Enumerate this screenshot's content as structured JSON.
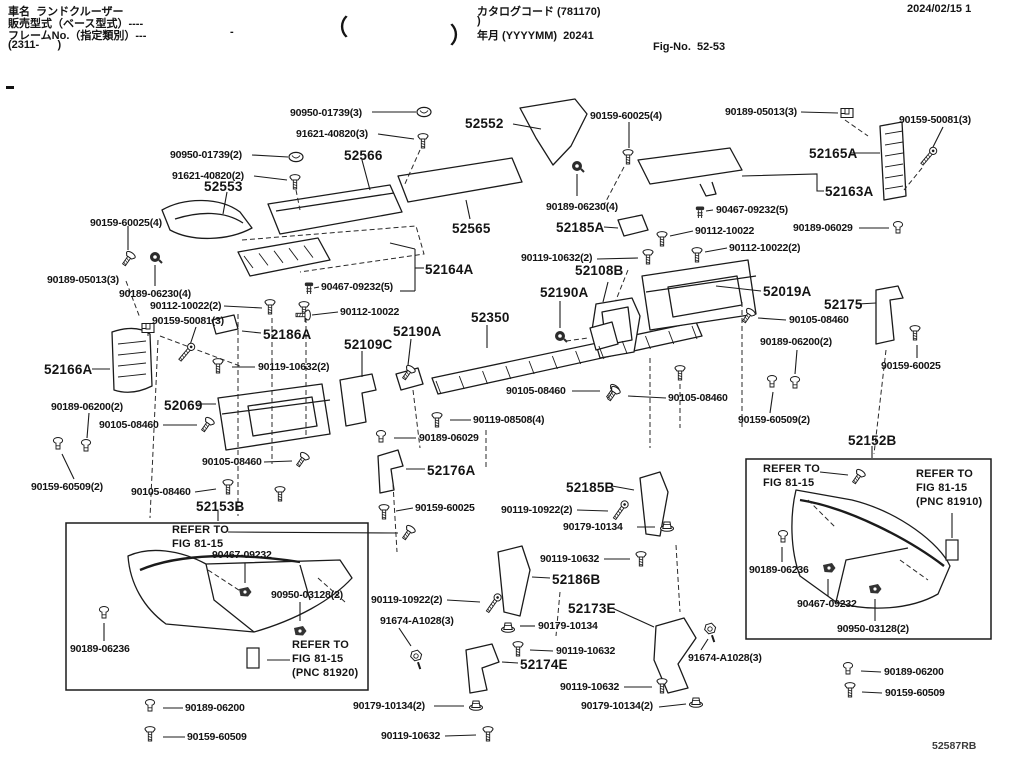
{
  "header": {
    "vehicle_name": "車名  ランドクルーザー",
    "sales_model": "販売型式（ベース型式）----",
    "frame_no": "フレームNo.（指定類別）---",
    "frame_range": "(2311-      )",
    "small_dash": "-",
    "brace_open": "（",
    "brace_close": "）",
    "catalog_code": "カタログコード (781170)",
    "catalog_code_cont": ")",
    "year_month": "年月 (YYYYMM)  20241",
    "fig_no": "Fig-No.  52-53",
    "print_date": "2024/02/15 1"
  },
  "footer": {
    "drawing_code": "52587RB"
  },
  "colors": {
    "ink": "#141414",
    "paper": "#ffffff"
  },
  "icon_types": [
    "bolt-icon",
    "screw-icon",
    "oval-clip-icon",
    "square-clip-icon",
    "push-nut-icon",
    "grommet-icon",
    "pin-icon",
    "rivet-clip-icon",
    "washer-nut-icon",
    "hex-screw-icon",
    "pnc-ref-icon"
  ],
  "labels": [
    {
      "t": "90950-01739(3)",
      "x": 290,
      "y": 107,
      "s": "sm"
    },
    {
      "t": "91621-40820(3)",
      "x": 296,
      "y": 128,
      "s": "sm"
    },
    {
      "t": "52552",
      "x": 465,
      "y": 116,
      "s": "lg"
    },
    {
      "t": "90159-60025(4)",
      "x": 590,
      "y": 110,
      "s": "sm"
    },
    {
      "t": "90189-05013(3)",
      "x": 725,
      "y": 106,
      "s": "sm"
    },
    {
      "t": "90159-50081(3)",
      "x": 899,
      "y": 114,
      "s": "sm"
    },
    {
      "t": "90950-01739(2)",
      "x": 170,
      "y": 149,
      "s": "sm"
    },
    {
      "t": "91621-40820(2)",
      "x": 172,
      "y": 170,
      "s": "sm"
    },
    {
      "t": "52566",
      "x": 344,
      "y": 148,
      "s": "lg"
    },
    {
      "t": "52165A",
      "x": 809,
      "y": 146,
      "s": "lg"
    },
    {
      "t": "52553",
      "x": 204,
      "y": 179,
      "s": "lg"
    },
    {
      "t": "52163A",
      "x": 825,
      "y": 184,
      "s": "lg"
    },
    {
      "t": "90189-06230(4)",
      "x": 546,
      "y": 201,
      "s": "sm"
    },
    {
      "t": "90467-09232(5)",
      "x": 716,
      "y": 204,
      "s": "sm"
    },
    {
      "t": "52185A",
      "x": 556,
      "y": 220,
      "s": "lg"
    },
    {
      "t": "90112-10022",
      "x": 695,
      "y": 225,
      "s": "sm"
    },
    {
      "t": "52565",
      "x": 452,
      "y": 221,
      "s": "lg"
    },
    {
      "t": "90159-60025(4)",
      "x": 90,
      "y": 217,
      "s": "sm"
    },
    {
      "t": "90189-06029",
      "x": 793,
      "y": 222,
      "s": "sm"
    },
    {
      "t": "90112-10022(2)",
      "x": 729,
      "y": 242,
      "s": "sm"
    },
    {
      "t": "90119-10632(2)",
      "x": 521,
      "y": 252,
      "s": "sm"
    },
    {
      "t": "52108B",
      "x": 575,
      "y": 263,
      "s": "lg"
    },
    {
      "t": "52164A",
      "x": 425,
      "y": 262,
      "s": "lg"
    },
    {
      "t": "90189-05013(3)",
      "x": 47,
      "y": 274,
      "s": "sm"
    },
    {
      "t": "90189-06230(4)",
      "x": 119,
      "y": 288,
      "s": "sm"
    },
    {
      "t": "52190A",
      "x": 540,
      "y": 285,
      "s": "lg"
    },
    {
      "t": "52019A",
      "x": 763,
      "y": 284,
      "s": "lg"
    },
    {
      "t": "90467-09232(5)",
      "x": 321,
      "y": 281,
      "s": "sm"
    },
    {
      "t": "52175",
      "x": 824,
      "y": 297,
      "s": "lg"
    },
    {
      "t": "90112-10022(2)",
      "x": 150,
      "y": 300,
      "s": "sm"
    },
    {
      "t": "90105-08460",
      "x": 789,
      "y": 314,
      "s": "sm"
    },
    {
      "t": "90112-10022",
      "x": 340,
      "y": 306,
      "s": "sm"
    },
    {
      "t": "90159-50081(3)",
      "x": 152,
      "y": 315,
      "s": "sm"
    },
    {
      "t": "52186A",
      "x": 263,
      "y": 327,
      "s": "lg"
    },
    {
      "t": "52109C",
      "x": 344,
      "y": 337,
      "s": "lg"
    },
    {
      "t": "52190A",
      "x": 393,
      "y": 324,
      "s": "lg"
    },
    {
      "t": "52350",
      "x": 471,
      "y": 310,
      "s": "lg"
    },
    {
      "t": "90189-06200(2)",
      "x": 760,
      "y": 336,
      "s": "sm"
    },
    {
      "t": "52166A",
      "x": 44,
      "y": 362,
      "s": "lg"
    },
    {
      "t": "90119-10632(2)",
      "x": 258,
      "y": 361,
      "s": "sm"
    },
    {
      "t": "90159-60025",
      "x": 881,
      "y": 360,
      "s": "sm"
    },
    {
      "t": "90105-08460",
      "x": 506,
      "y": 385,
      "s": "sm"
    },
    {
      "t": "90189-06200(2)",
      "x": 51,
      "y": 401,
      "s": "sm"
    },
    {
      "t": "52069",
      "x": 164,
      "y": 398,
      "s": "lg"
    },
    {
      "t": "90105-08460",
      "x": 99,
      "y": 419,
      "s": "sm"
    },
    {
      "t": "90105-08460",
      "x": 668,
      "y": 392,
      "s": "sm"
    },
    {
      "t": "90119-08508(4)",
      "x": 473,
      "y": 414,
      "s": "sm"
    },
    {
      "t": "90189-06029",
      "x": 419,
      "y": 432,
      "s": "sm"
    },
    {
      "t": "90159-60509(2)",
      "x": 738,
      "y": 414,
      "s": "sm"
    },
    {
      "t": "52152B",
      "x": 848,
      "y": 433,
      "s": "lg"
    },
    {
      "t": "90105-08460",
      "x": 202,
      "y": 456,
      "s": "sm"
    },
    {
      "t": "52176A",
      "x": 427,
      "y": 463,
      "s": "lg"
    },
    {
      "t": "52185B",
      "x": 566,
      "y": 480,
      "s": "lg"
    },
    {
      "t": "90159-60509(2)",
      "x": 31,
      "y": 481,
      "s": "sm"
    },
    {
      "t": "90105-08460",
      "x": 131,
      "y": 486,
      "s": "sm"
    },
    {
      "t": "52153B",
      "x": 196,
      "y": 499,
      "s": "lg"
    },
    {
      "t": "90159-60025",
      "x": 415,
      "y": 502,
      "s": "sm"
    },
    {
      "t": "90119-10922(2)",
      "x": 501,
      "y": 504,
      "s": "sm"
    },
    {
      "t": "90179-10134",
      "x": 563,
      "y": 521,
      "s": "sm"
    },
    {
      "t": "REFER TO\nFIG 81-15",
      "x": 763,
      "y": 463,
      "s": "note"
    },
    {
      "t": "REFER TO\nFIG 81-15\n(PNC 81910)",
      "x": 916,
      "y": 468,
      "s": "note"
    },
    {
      "t": "90119-10632",
      "x": 540,
      "y": 553,
      "s": "sm"
    },
    {
      "t": "REFER TO\nFIG 81-15",
      "x": 172,
      "y": 524,
      "s": "note"
    },
    {
      "t": "90467-09232",
      "x": 212,
      "y": 549,
      "s": "sm"
    },
    {
      "t": "52186B",
      "x": 552,
      "y": 572,
      "s": "lg"
    },
    {
      "t": "90950-03128(2)",
      "x": 271,
      "y": 589,
      "s": "sm"
    },
    {
      "t": "90119-10922(2)",
      "x": 371,
      "y": 594,
      "s": "sm"
    },
    {
      "t": "52173E",
      "x": 568,
      "y": 601,
      "s": "lg"
    },
    {
      "t": "91674-A1028(3)",
      "x": 380,
      "y": 615,
      "s": "sm"
    },
    {
      "t": "90189-06236",
      "x": 749,
      "y": 564,
      "s": "sm"
    },
    {
      "t": "90467-09232",
      "x": 797,
      "y": 598,
      "s": "sm"
    },
    {
      "t": "90179-10134",
      "x": 538,
      "y": 620,
      "s": "sm"
    },
    {
      "t": "90950-03128(2)",
      "x": 837,
      "y": 623,
      "s": "sm"
    },
    {
      "t": "90119-10632",
      "x": 556,
      "y": 645,
      "s": "sm"
    },
    {
      "t": "90189-06236",
      "x": 70,
      "y": 643,
      "s": "sm"
    },
    {
      "t": "52174E",
      "x": 520,
      "y": 657,
      "s": "lg"
    },
    {
      "t": "REFER TO\nFIG 81-15\n(PNC 81920)",
      "x": 292,
      "y": 639,
      "s": "note"
    },
    {
      "t": "91674-A1028(3)",
      "x": 688,
      "y": 652,
      "s": "sm"
    },
    {
      "t": "90189-06200",
      "x": 884,
      "y": 666,
      "s": "sm"
    },
    {
      "t": "90119-10632",
      "x": 560,
      "y": 681,
      "s": "sm"
    },
    {
      "t": "90159-60509",
      "x": 885,
      "y": 687,
      "s": "sm"
    },
    {
      "t": "90189-06200",
      "x": 185,
      "y": 702,
      "s": "sm"
    },
    {
      "t": "90179-10134(2)",
      "x": 353,
      "y": 700,
      "s": "sm"
    },
    {
      "t": "90179-10134(2)",
      "x": 581,
      "y": 700,
      "s": "sm"
    },
    {
      "t": "90159-60509",
      "x": 187,
      "y": 731,
      "s": "sm"
    },
    {
      "t": "90119-10632",
      "x": 381,
      "y": 730,
      "s": "sm"
    }
  ],
  "icons": [
    {
      "t": "clip",
      "x": 424,
      "y": 112,
      "r": 0
    },
    {
      "t": "bolt",
      "x": 423,
      "y": 141,
      "r": 0
    },
    {
      "t": "clip",
      "x": 296,
      "y": 157,
      "r": 0
    },
    {
      "t": "bolt",
      "x": 295,
      "y": 182,
      "r": 0
    },
    {
      "t": "bolt",
      "x": 628,
      "y": 157,
      "r": 0
    },
    {
      "t": "clip2",
      "x": 847,
      "y": 113,
      "r": 0
    },
    {
      "t": "screw",
      "x": 928,
      "y": 157,
      "r": 40
    },
    {
      "t": "nut",
      "x": 577,
      "y": 166,
      "r": 0
    },
    {
      "t": "pin",
      "x": 700,
      "y": 212,
      "r": 0
    },
    {
      "t": "bolt",
      "x": 662,
      "y": 239,
      "r": 0
    },
    {
      "t": "grommet",
      "x": 898,
      "y": 228,
      "r": 0
    },
    {
      "t": "bolt",
      "x": 697,
      "y": 255,
      "r": 0
    },
    {
      "t": "bolt",
      "x": 648,
      "y": 257,
      "r": 0
    },
    {
      "t": "bolt",
      "x": 128,
      "y": 259,
      "r": 35
    },
    {
      "t": "nut",
      "x": 155,
      "y": 257,
      "r": 0
    },
    {
      "t": "clip2",
      "x": 148,
      "y": 328,
      "r": 0
    },
    {
      "t": "screw",
      "x": 186,
      "y": 353,
      "r": 40
    },
    {
      "t": "bolt",
      "x": 270,
      "y": 307,
      "r": 0
    },
    {
      "t": "bolt",
      "x": 304,
      "y": 309,
      "r": 0
    },
    {
      "t": "pin",
      "x": 309,
      "y": 288,
      "r": 0
    },
    {
      "t": "bolt",
      "x": 303,
      "y": 315,
      "r": 90
    },
    {
      "t": "bolt",
      "x": 408,
      "y": 373,
      "r": 35
    },
    {
      "t": "nut",
      "x": 560,
      "y": 336,
      "r": 0
    },
    {
      "t": "bolt",
      "x": 612,
      "y": 392,
      "r": 35
    },
    {
      "t": "bolt",
      "x": 437,
      "y": 420,
      "r": 0
    },
    {
      "t": "grommet",
      "x": 381,
      "y": 437,
      "r": 0
    },
    {
      "t": "bolt",
      "x": 613,
      "y": 394,
      "r": 35
    },
    {
      "t": "bolt",
      "x": 680,
      "y": 373,
      "r": 0
    },
    {
      "t": "grommet",
      "x": 772,
      "y": 382,
      "r": 0
    },
    {
      "t": "grommet",
      "x": 795,
      "y": 383,
      "r": 0
    },
    {
      "t": "bolt",
      "x": 748,
      "y": 316,
      "r": 35
    },
    {
      "t": "bolt",
      "x": 915,
      "y": 333,
      "r": 0
    },
    {
      "t": "grommet",
      "x": 58,
      "y": 444,
      "r": 0
    },
    {
      "t": "grommet",
      "x": 86,
      "y": 446,
      "r": 0
    },
    {
      "t": "bolt",
      "x": 207,
      "y": 425,
      "r": 35
    },
    {
      "t": "bolt",
      "x": 302,
      "y": 460,
      "r": 35
    },
    {
      "t": "bolt",
      "x": 228,
      "y": 487,
      "r": 0
    },
    {
      "t": "bolt",
      "x": 218,
      "y": 366,
      "r": 0
    },
    {
      "t": "bolt",
      "x": 280,
      "y": 494,
      "r": 0
    },
    {
      "t": "bolt",
      "x": 384,
      "y": 512,
      "r": 0
    },
    {
      "t": "screw",
      "x": 620,
      "y": 511,
      "r": 35
    },
    {
      "t": "wnut",
      "x": 667,
      "y": 526,
      "r": 0
    },
    {
      "t": "bolt",
      "x": 858,
      "y": 477,
      "r": 35
    },
    {
      "t": "bolt",
      "x": 641,
      "y": 559,
      "r": 0
    },
    {
      "t": "bolt",
      "x": 408,
      "y": 533,
      "r": 35
    },
    {
      "t": "rivet",
      "x": 245,
      "y": 592,
      "r": 0
    },
    {
      "t": "rivet",
      "x": 300,
      "y": 631,
      "r": 0
    },
    {
      "t": "screw",
      "x": 493,
      "y": 604,
      "r": 35
    },
    {
      "t": "hex",
      "x": 416,
      "y": 656,
      "r": 15
    },
    {
      "t": "grommet",
      "x": 783,
      "y": 537,
      "r": 0
    },
    {
      "t": "rivet",
      "x": 829,
      "y": 568,
      "r": 0
    },
    {
      "t": "wnut",
      "x": 508,
      "y": 627,
      "r": 0
    },
    {
      "t": "rivet",
      "x": 875,
      "y": 589,
      "r": 0
    },
    {
      "t": "bolt",
      "x": 518,
      "y": 649,
      "r": 0
    },
    {
      "t": "grommet",
      "x": 104,
      "y": 613,
      "r": 0
    },
    {
      "t": "rect",
      "x": 253,
      "y": 658,
      "r": 0
    },
    {
      "t": "rect",
      "x": 952,
      "y": 550,
      "r": 0
    },
    {
      "t": "hex",
      "x": 710,
      "y": 629,
      "r": 15
    },
    {
      "t": "grommet",
      "x": 848,
      "y": 669,
      "r": 0
    },
    {
      "t": "bolt",
      "x": 850,
      "y": 690,
      "r": 0
    },
    {
      "t": "grommet",
      "x": 150,
      "y": 706,
      "r": 0
    },
    {
      "t": "bolt",
      "x": 150,
      "y": 734,
      "r": 0
    },
    {
      "t": "wnut",
      "x": 476,
      "y": 705,
      "r": 0
    },
    {
      "t": "bolt",
      "x": 488,
      "y": 734,
      "r": 0
    },
    {
      "t": "wnut",
      "x": 696,
      "y": 702,
      "r": 0
    },
    {
      "t": "bolt",
      "x": 662,
      "y": 686,
      "r": 0
    }
  ]
}
